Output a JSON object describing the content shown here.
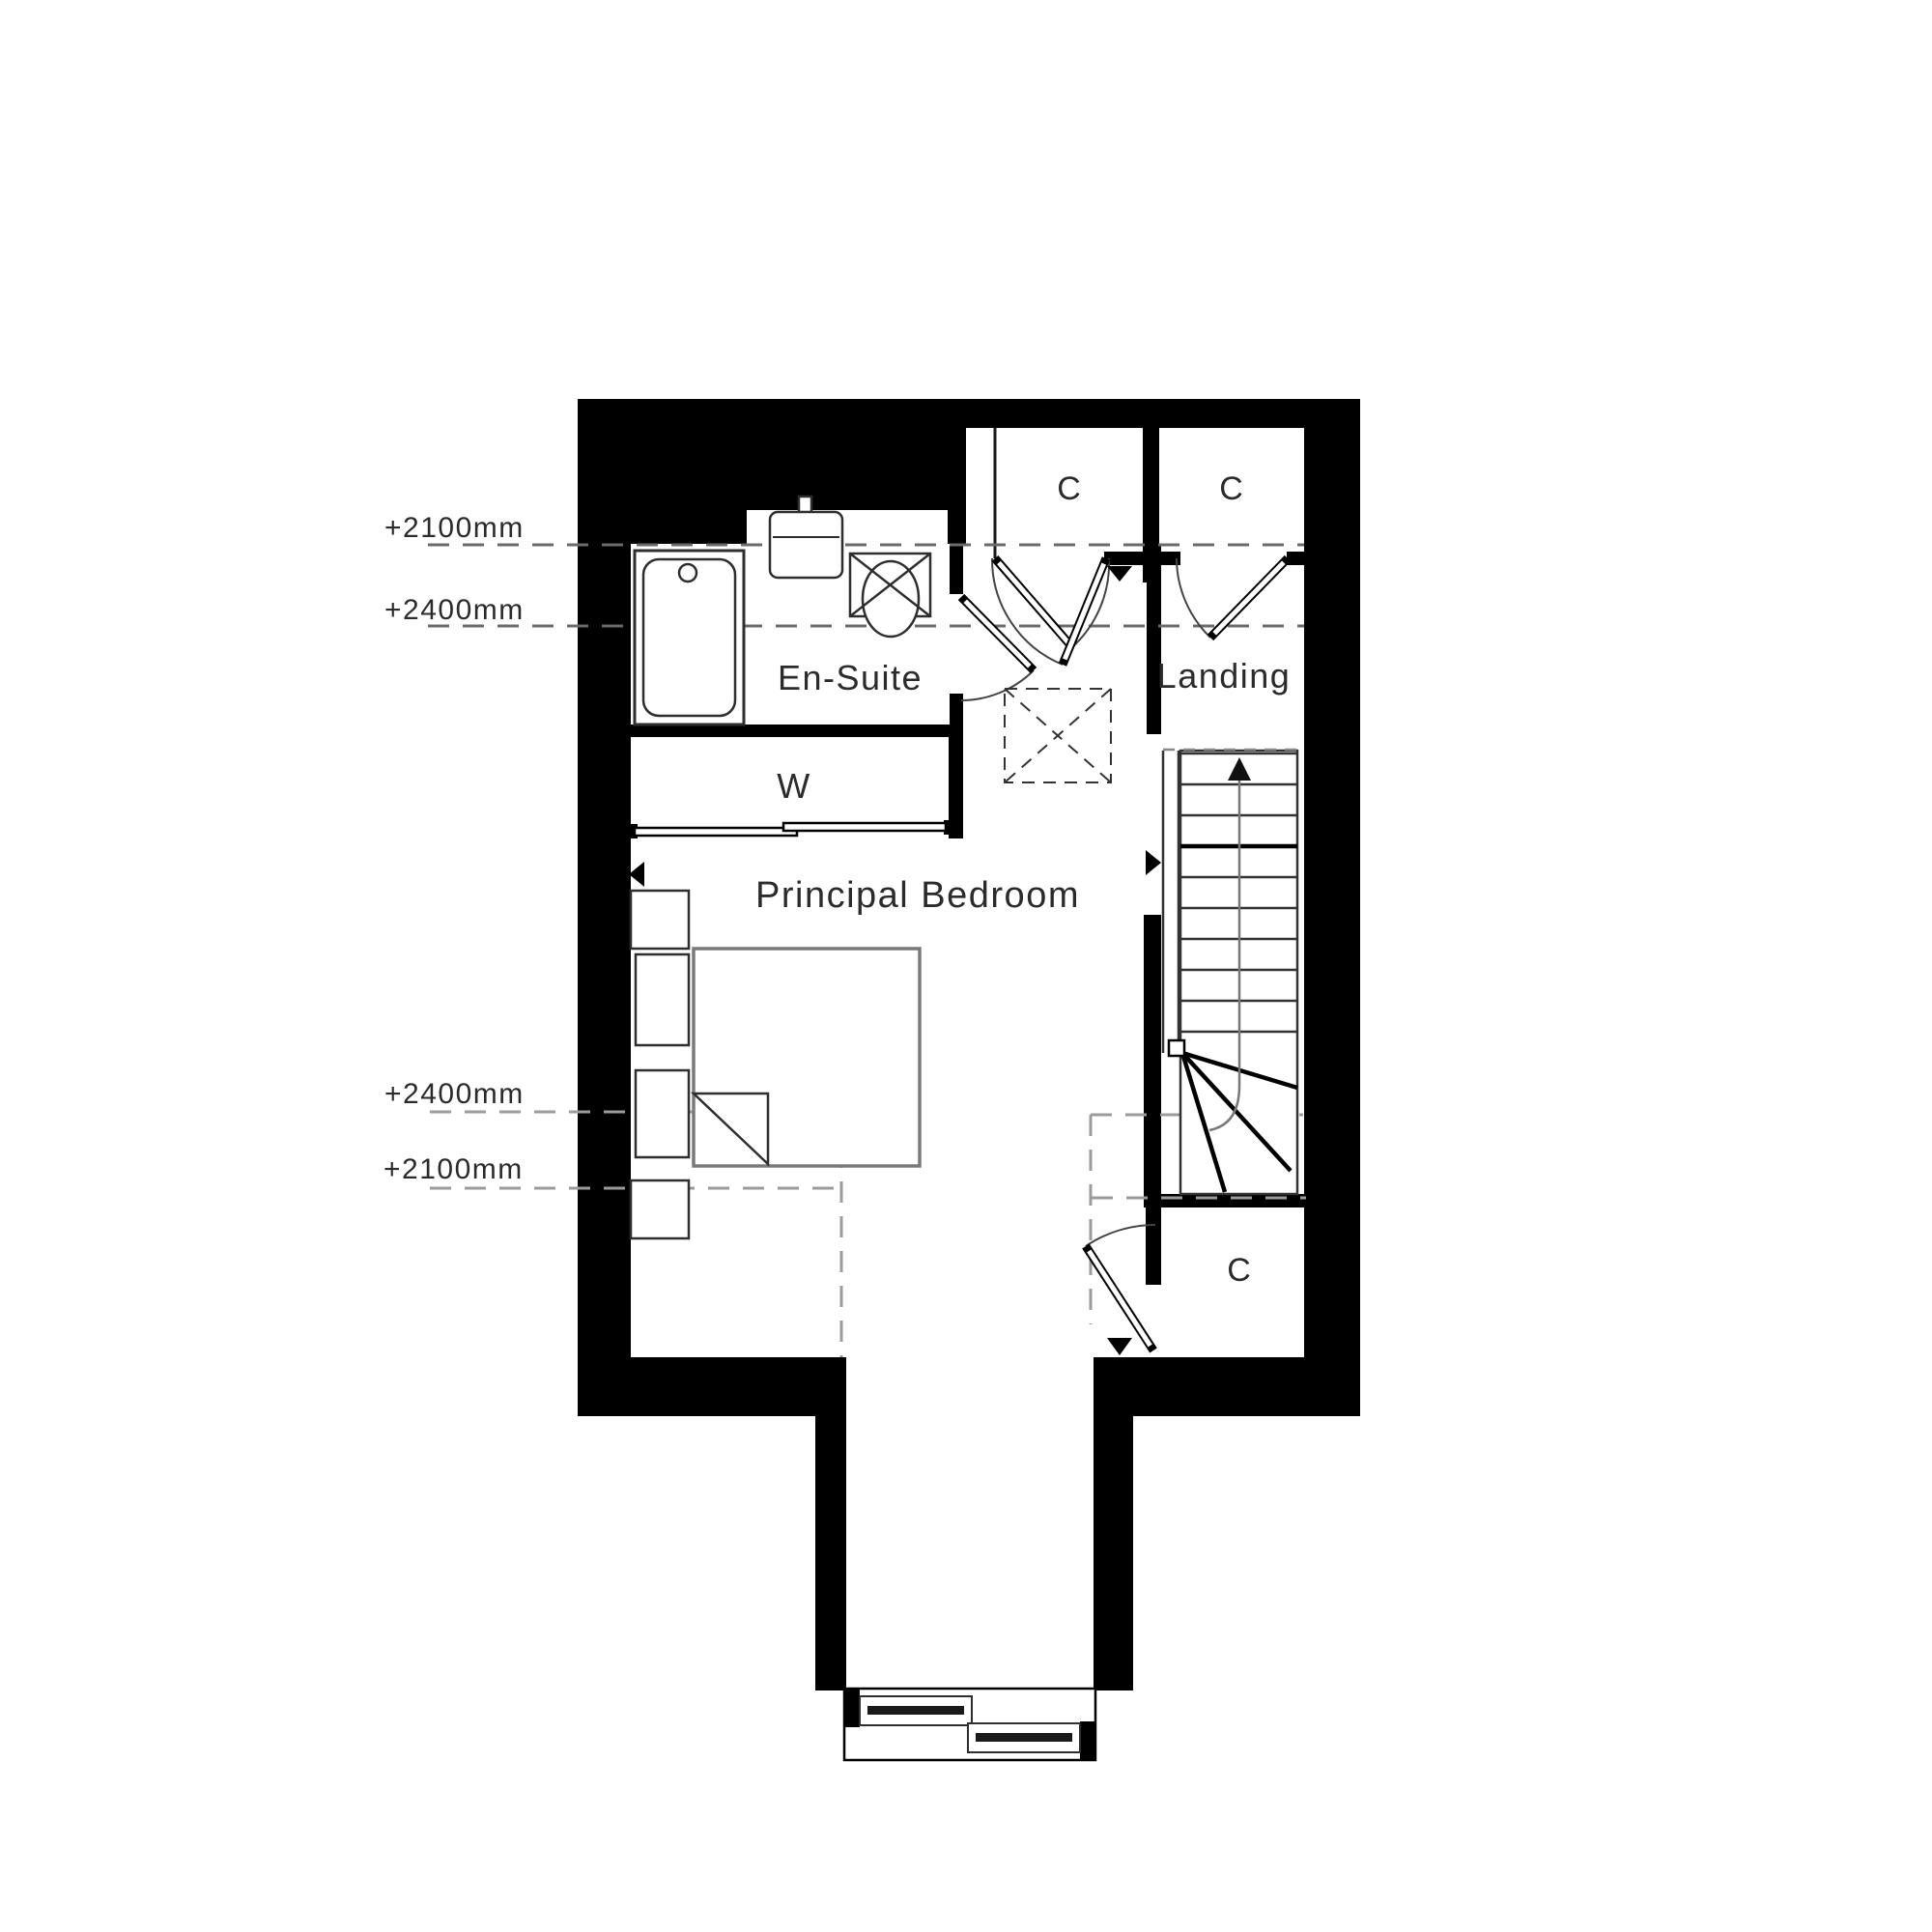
{
  "floor_plan": {
    "rooms": {
      "en_suite": "En-Suite",
      "landing": "Landing",
      "wardrobe": "W",
      "principal_bedroom": "Principal Bedroom",
      "closet_top_left": "C",
      "closet_top_right": "C",
      "closet_bottom": "C"
    },
    "ceiling_height_markers": {
      "upper_2100": "+2100mm",
      "upper_2400": "+2400mm",
      "lower_2400": "+2400mm",
      "lower_2100": "+2100mm"
    },
    "colors": {
      "wall": "#000000",
      "fixture_line": "#2e2e2e",
      "furniture_grey": "#7a7a7a",
      "dash_dark": "#6a6a6a",
      "dash_light": "#9b9b9b",
      "text": "#2b2b2b",
      "background": "#ffffff"
    },
    "icons": {
      "bath": "bath-icon",
      "sink": "sink-icon",
      "toilet": "toilet-icon",
      "bed": "bed-icon",
      "stairs": "stairs-up-arrow-icon",
      "rooflight": "rooflight-hatch-icon",
      "sliding_wardrobe": "sliding-door-icon",
      "window": "sliding-window-icon"
    }
  }
}
